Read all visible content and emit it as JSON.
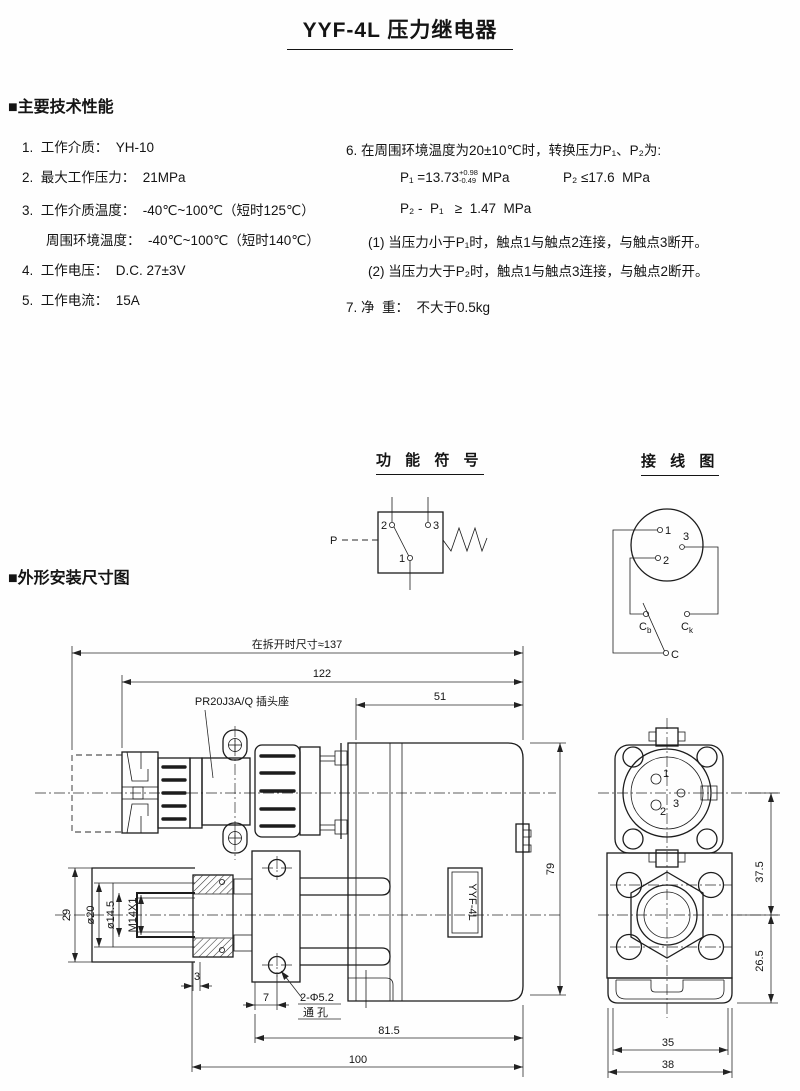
{
  "title": "YYF-4L 压力继电器",
  "specs": {
    "heading": "■主要技术性能",
    "left": [
      "1.  工作介质：  YH-10",
      "2.  最大工作压力：  21MPa",
      "3.  工作介质温度：  -40℃~100℃（短时125℃）",
      "周围环境温度：  -40℃~100℃（短时140℃）",
      "4.  工作电压：  D.C. 27±3V",
      "5.  工作电流：  15A"
    ],
    "right": {
      "item6": "6. 在周围环境温度为20±10℃时，转换压力P₁、P₂为:",
      "p1_prefix": "P₁ =13.73",
      "p1_tol_top": "+0.98",
      "p1_tol_bottom": "-0.49",
      "p1_unit": " MPa",
      "p2_formula": "P₂ ≤17.6  MPa",
      "diff_formula": "P₂ -  P₁   ≥  1.47  MPa",
      "note1": "(1) 当压力小于P₁时，触点1与触点2连接，与触点3断开。",
      "note2": "(2) 当压力大于P₂时，触点1与触点3连接，与触点2断开。",
      "item7": "7. 净  重：  不大于0.5kg"
    }
  },
  "function_diagram": {
    "title": "功 能 符 号",
    "label_p": "P",
    "c1": "1",
    "c2": "2",
    "c3": "3"
  },
  "wiring_diagram": {
    "title": "接 线 图",
    "p1": "1",
    "p2": "2",
    "p3": "3",
    "cb_main": "C",
    "cb_sub": "b",
    "ck_main": "C",
    "ck_sub": "k",
    "c": "C"
  },
  "drawing": {
    "heading": "■外形安装尺寸图",
    "plug_label": "PR20J3A/Q 插头座",
    "body_label": "YYF-4L",
    "holes_label_line1": "2-Φ5.2",
    "holes_label_line2": "通  孔",
    "dims": {
      "overall": "在拆开时尺寸≈137",
      "d122": "122",
      "d51": "51",
      "d79": "79",
      "d29": "29",
      "d20": "ø20",
      "d14_5": "ø14.5",
      "m14": "M14X1",
      "d3": "3",
      "d7": "7",
      "d81_5": "81.5",
      "d100": "100",
      "d37_5": "37.5",
      "d26_5": "26.5",
      "d35": "35",
      "d38": "38"
    },
    "pins": {
      "p1": "1",
      "p2": "2",
      "p3": "3"
    }
  }
}
